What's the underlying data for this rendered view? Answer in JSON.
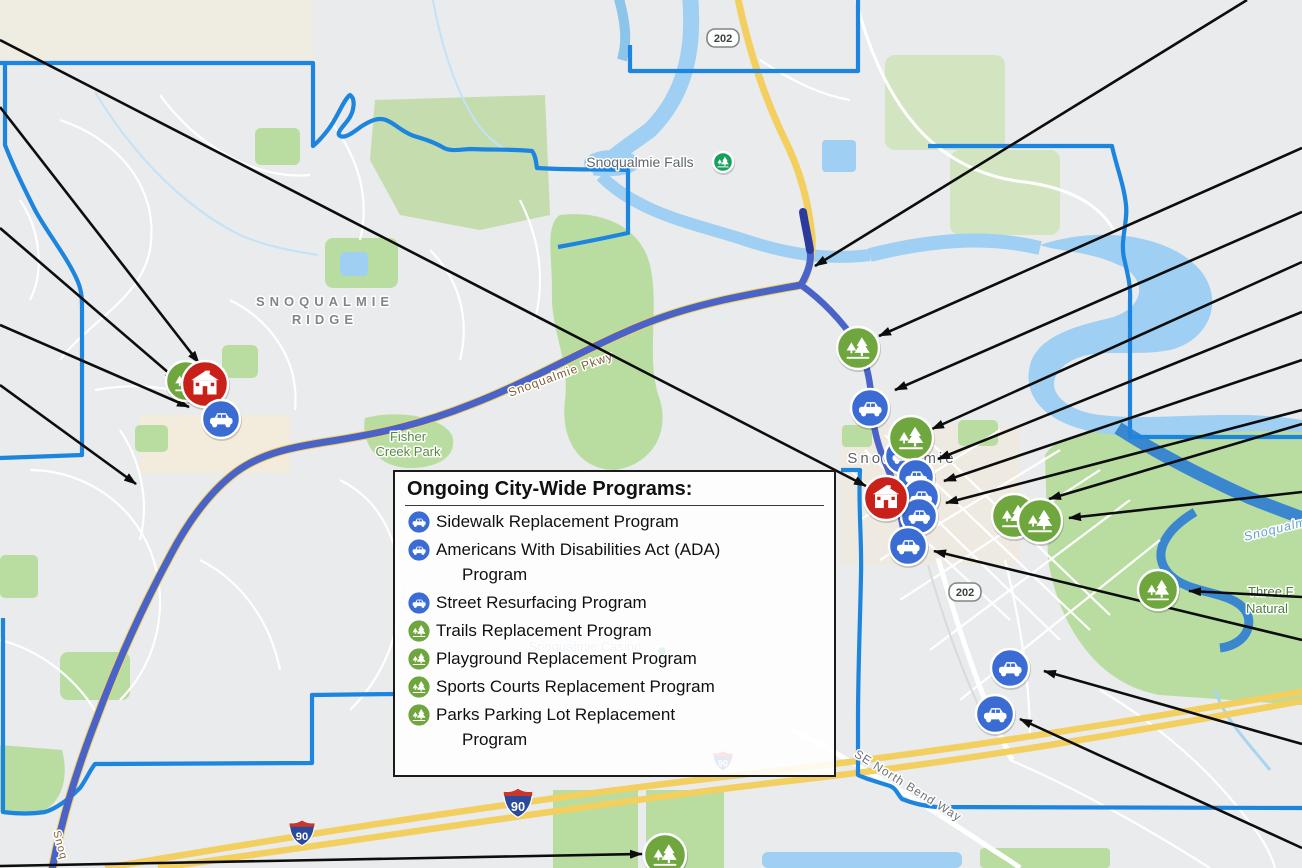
{
  "legend": {
    "title": "Ongoing City-Wide Programs:",
    "items": [
      {
        "icon": "car",
        "label": "Sidewalk Replacement Program",
        "label2": ""
      },
      {
        "icon": "car",
        "label": "Americans With Disabilities Act (ADA)",
        "label2": "Program"
      },
      {
        "icon": "car",
        "label": "Street Resurfacing Program",
        "label2": ""
      },
      {
        "icon": "park",
        "label": "Trails Replacement Program",
        "label2": ""
      },
      {
        "icon": "park",
        "label": "Playground Replacement Program",
        "label2": ""
      },
      {
        "icon": "park",
        "label": "Sports Courts Replacement Program",
        "label2": ""
      },
      {
        "icon": "park",
        "label": "Parks Parking Lot Replacement",
        "label2": "Program"
      }
    ]
  },
  "map_labels": [
    {
      "id": "ridge-line1",
      "text": "SNOQUALMIE",
      "x": 325,
      "y": 306,
      "size": 13,
      "color": "#7f868d",
      "ls": 5,
      "bold": true,
      "rot": 0,
      "anchor": "middle"
    },
    {
      "id": "ridge-line2",
      "text": "RIDGE",
      "x": 325,
      "y": 324,
      "size": 13,
      "color": "#7f868d",
      "ls": 5,
      "bold": true,
      "rot": 0,
      "anchor": "middle"
    },
    {
      "id": "snoqualmie-falls",
      "text": "Snoqualmie Falls",
      "x": 640,
      "y": 167,
      "size": 14,
      "color": "#5c676e",
      "ls": 0,
      "bold": false,
      "rot": 0,
      "anchor": "middle"
    },
    {
      "id": "fisher-line1",
      "text": "Fisher",
      "x": 408,
      "y": 441,
      "size": 13,
      "color": "#578a40",
      "ls": 0,
      "bold": false,
      "rot": 0,
      "anchor": "middle"
    },
    {
      "id": "fisher-line2",
      "text": "Creek Park",
      "x": 408,
      "y": 456,
      "size": 13,
      "color": "#578a40",
      "ls": 0,
      "bold": false,
      "rot": 0,
      "anchor": "middle"
    },
    {
      "id": "snoqualmie-pkwy",
      "text": "Snoqualmie Pkwy",
      "x": 562,
      "y": 378,
      "size": 12,
      "color": "#7d5f35",
      "ls": 1,
      "bold": false,
      "rot": -20,
      "anchor": "middle"
    },
    {
      "id": "city-snoqualmie",
      "text": "Snoqualmie",
      "x": 902,
      "y": 463,
      "size": 15,
      "color": "#5d6269",
      "ls": 3,
      "bold": false,
      "rot": 0,
      "anchor": "middle"
    },
    {
      "id": "snoqualmie-casino",
      "text": "Snoqualmie Casino",
      "x": 585,
      "y": 651,
      "size": 13,
      "color": "#7fa3c2",
      "ls": 0,
      "bold": false,
      "rot": 0,
      "anchor": "middle"
    },
    {
      "id": "se-north-bend-way",
      "text": "SE North Bend Way",
      "x": 906,
      "y": 789,
      "size": 12,
      "color": "#6d7277",
      "ls": 1,
      "bold": false,
      "rot": 32,
      "anchor": "middle"
    },
    {
      "id": "river-snoqualmie",
      "text": "Snoqualmi",
      "x": 1245,
      "y": 541,
      "size": 12.5,
      "color": "#63a2cb",
      "ls": 1,
      "bold": false,
      "rot": -14,
      "anchor": "start",
      "italic": true
    },
    {
      "id": "three-forks-line1",
      "text": "Three F",
      "x": 1248,
      "y": 596,
      "size": 13,
      "color": "#4a8040",
      "ls": 0,
      "bold": false,
      "rot": 0,
      "anchor": "start"
    },
    {
      "id": "three-forks-line2",
      "text": "Natural",
      "x": 1246,
      "y": 613,
      "size": 13,
      "color": "#4a8040",
      "ls": 0,
      "bold": false,
      "rot": 0,
      "anchor": "start"
    },
    {
      "id": "pkwy-street-bottom",
      "text": "Snoq",
      "x": 57,
      "y": 846,
      "size": 11,
      "color": "#7d5f35",
      "ls": 1,
      "bold": false,
      "rot": 75,
      "anchor": "middle"
    }
  ],
  "shields": [
    {
      "kind": "state",
      "text": "202",
      "x": 723,
      "y": 38
    },
    {
      "kind": "state",
      "text": "202",
      "x": 965,
      "y": 592
    },
    {
      "kind": "interstate",
      "text": "90",
      "x": 302,
      "y": 833,
      "s": 28
    },
    {
      "kind": "interstate",
      "text": "90",
      "x": 518,
      "y": 803,
      "s": 32
    },
    {
      "kind": "interstate",
      "text": "90",
      "x": 723,
      "y": 761,
      "s": 22
    }
  ],
  "markers": [
    {
      "type": "park",
      "x": 186,
      "y": 381,
      "r": 20
    },
    {
      "type": "school",
      "x": 205,
      "y": 384,
      "r": 23
    },
    {
      "type": "car",
      "x": 221,
      "y": 419,
      "r": 19
    },
    {
      "type": "park",
      "x": 858,
      "y": 348,
      "r": 21
    },
    {
      "type": "car",
      "x": 870,
      "y": 408,
      "r": 19
    },
    {
      "type": "car",
      "x": 903,
      "y": 456,
      "r": 18
    },
    {
      "type": "park",
      "x": 911,
      "y": 438,
      "r": 22
    },
    {
      "type": "car",
      "x": 916,
      "y": 477,
      "r": 18
    },
    {
      "type": "car",
      "x": 921,
      "y": 497,
      "r": 18
    },
    {
      "type": "car",
      "x": 919,
      "y": 516,
      "r": 18
    },
    {
      "type": "school",
      "x": 886,
      "y": 498,
      "r": 22
    },
    {
      "type": "car",
      "x": 908,
      "y": 546,
      "r": 19
    },
    {
      "type": "park",
      "x": 1014,
      "y": 516,
      "r": 22
    },
    {
      "type": "park",
      "x": 1040,
      "y": 521,
      "r": 22
    },
    {
      "type": "park",
      "x": 1158,
      "y": 590,
      "r": 20
    },
    {
      "type": "car",
      "x": 1010,
      "y": 668,
      "r": 19
    },
    {
      "type": "car",
      "x": 995,
      "y": 714,
      "r": 19
    },
    {
      "type": "park",
      "x": 665,
      "y": 855,
      "r": 21
    },
    {
      "type": "poi",
      "x": 723,
      "y": 162,
      "r": 10
    },
    {
      "type": "poi",
      "x": 662,
      "y": 651,
      "r": 5
    }
  ],
  "arrows": [
    {
      "x1": 0,
      "y1": 40,
      "x2": 866,
      "y2": 486
    },
    {
      "x1": 0,
      "y1": 107,
      "x2": 199,
      "y2": 363
    },
    {
      "x1": 0,
      "y1": 228,
      "x2": 177,
      "y2": 380
    },
    {
      "x1": 0,
      "y1": 325,
      "x2": 189,
      "y2": 407
    },
    {
      "x1": 0,
      "y1": 385,
      "x2": 136,
      "y2": 484
    },
    {
      "x1": 0,
      "y1": 866,
      "x2": 642,
      "y2": 854
    },
    {
      "x1": 1247,
      "y1": 0,
      "x2": 815,
      "y2": 266
    },
    {
      "x1": 1302,
      "y1": 148,
      "x2": 879,
      "y2": 336
    },
    {
      "x1": 1302,
      "y1": 212,
      "x2": 895,
      "y2": 390
    },
    {
      "x1": 1302,
      "y1": 262,
      "x2": 932,
      "y2": 429
    },
    {
      "x1": 1302,
      "y1": 312,
      "x2": 938,
      "y2": 459
    },
    {
      "x1": 1302,
      "y1": 360,
      "x2": 944,
      "y2": 481
    },
    {
      "x1": 1302,
      "y1": 410,
      "x2": 946,
      "y2": 503
    },
    {
      "x1": 1302,
      "y1": 640,
      "x2": 934,
      "y2": 551
    },
    {
      "x1": 1302,
      "y1": 424,
      "x2": 1049,
      "y2": 499
    },
    {
      "x1": 1302,
      "y1": 492,
      "x2": 1069,
      "y2": 518
    },
    {
      "x1": 1302,
      "y1": 597,
      "x2": 1189,
      "y2": 591
    },
    {
      "x1": 1302,
      "y1": 744,
      "x2": 1044,
      "y2": 671
    },
    {
      "x1": 1302,
      "y1": 848,
      "x2": 1020,
      "y2": 719
    }
  ],
  "colors": {
    "car": "#3b6cd4",
    "park": "#6fa63e",
    "school": "#c9201a",
    "poi": "#17a05c",
    "route": "#4a63c8",
    "route_dark": "#2b3a9c",
    "boundary": "#1d85de",
    "arrow": "#0d0d0d"
  }
}
